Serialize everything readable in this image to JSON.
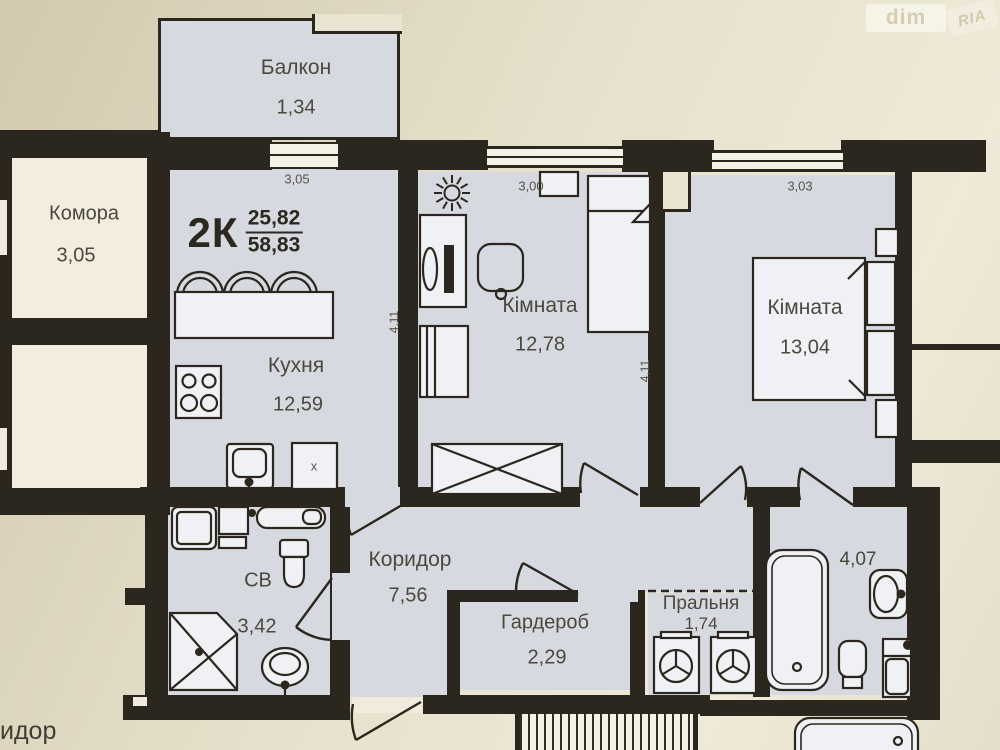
{
  "watermark": {
    "dim": "dim",
    "ria": "RIA"
  },
  "plan": {
    "apartment": {
      "type": "2К",
      "area_living": "25,82",
      "area_total": "58,83"
    },
    "rooms": {
      "balcony": {
        "name": "Балкон",
        "area": "1,34"
      },
      "storage": {
        "name": "Комора",
        "area": "3,05"
      },
      "kitchen": {
        "name": "Кухня",
        "area": "12,59"
      },
      "room1": {
        "name": "Кімната",
        "area": "12,78"
      },
      "room2": {
        "name": "Кімната",
        "area": "13,04"
      },
      "bathroom": {
        "name": "СВ",
        "area": "3,42"
      },
      "corridor": {
        "name": "Коридор",
        "area": "7,56"
      },
      "wardrobe": {
        "name": "Гардероб",
        "area": "2,29"
      },
      "laundry": {
        "name": "Пральня",
        "area": "1,74"
      },
      "bathroom2": {
        "area": "4,07"
      }
    },
    "dimensions": {
      "kitchen_width": "3,05",
      "kitchen_depth": "4,11",
      "room1_width": "3,00",
      "room1_depth": "4,11",
      "room2_width": "3,03"
    },
    "annotations": {
      "fixture_x": "x",
      "outside_text": "идор"
    }
  },
  "colors": {
    "wall": "#2c271e",
    "room_fill": "#d7d9e0",
    "outside": "#e3dcc8",
    "furniture": "#f0f1f5"
  }
}
